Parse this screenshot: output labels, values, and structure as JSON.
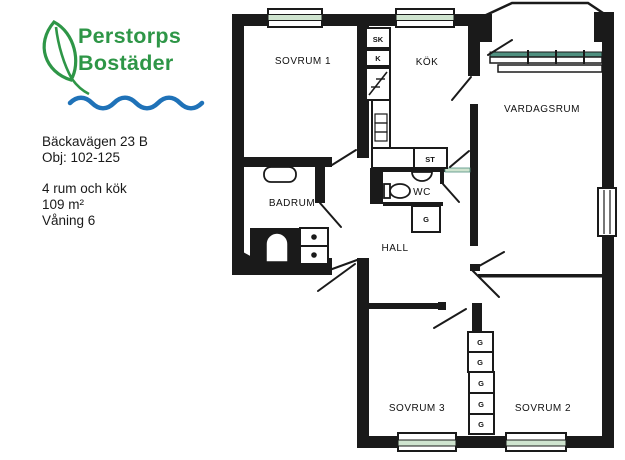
{
  "logo": {
    "name_line1": "Perstorps",
    "name_line2": "Bostäder",
    "green": "#2e9647",
    "blue": "#1f72b8"
  },
  "icons": {
    "leaf": "leaf-icon",
    "wave": "wave-icon"
  },
  "listing": {
    "address": "Bäckavägen 23 B",
    "object_id": "Obj: 102-125",
    "rooms": "4 rum och kök",
    "area": "109 m²",
    "floor": "Våning 6"
  },
  "floorplan": {
    "rooms": {
      "sovrum1": "SOVRUM 1",
      "kok": "KÖK",
      "vardagsrum": "VARDAGSRUM",
      "badrum": "BADRUM",
      "wc": "WC",
      "hall": "HALL",
      "sovrum3": "SOVRUM 3",
      "sovrum2": "SOVRUM 2"
    },
    "closets": {
      "sk": "SK",
      "k": "K",
      "st": "ST",
      "g": "G"
    },
    "colors": {
      "wall": "#1a1a1a",
      "window_tint": "#cfe4cf",
      "window_teal": "#4f9080"
    }
  }
}
